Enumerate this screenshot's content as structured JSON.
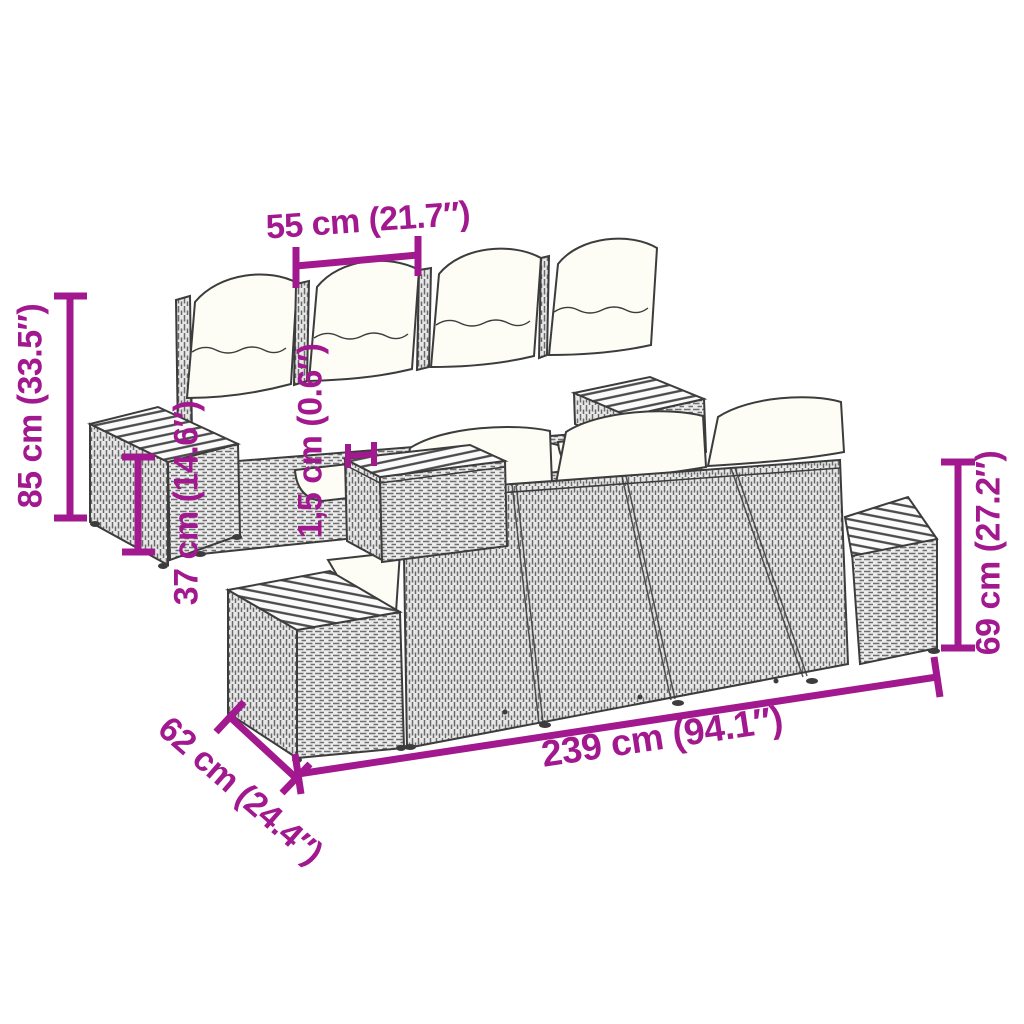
{
  "title": "Garden sofa set dimension diagram",
  "figures": {
    "front_view": "3-seat rattan sofa with side tables, front view",
    "back_view": "3-seat rattan sofa with side tables, back view"
  },
  "dimensions": {
    "seat_width": {
      "label": "55 cm (21.7″)"
    },
    "total_height": {
      "label": "85 cm (33.5″)"
    },
    "table_height": {
      "label": "37 cm (14.6″)"
    },
    "tabletop_thickness": {
      "label": "1,5 cm (0.6″)"
    },
    "backrest_height": {
      "label": "69 cm (27.2″)"
    },
    "total_length": {
      "label": "239 cm (94.1″)"
    },
    "depth": {
      "label": "62 cm (24.4″)"
    }
  },
  "colors": {
    "accent": "#A2188E",
    "line": "#3C3C3C",
    "cushion": "#FDFDF6",
    "weave_bg": "#ECECEC",
    "weave_stroke": "#6E6E6E",
    "slat_bg": "#FBFBFB",
    "slat_stroke": "#4A4A4A"
  }
}
